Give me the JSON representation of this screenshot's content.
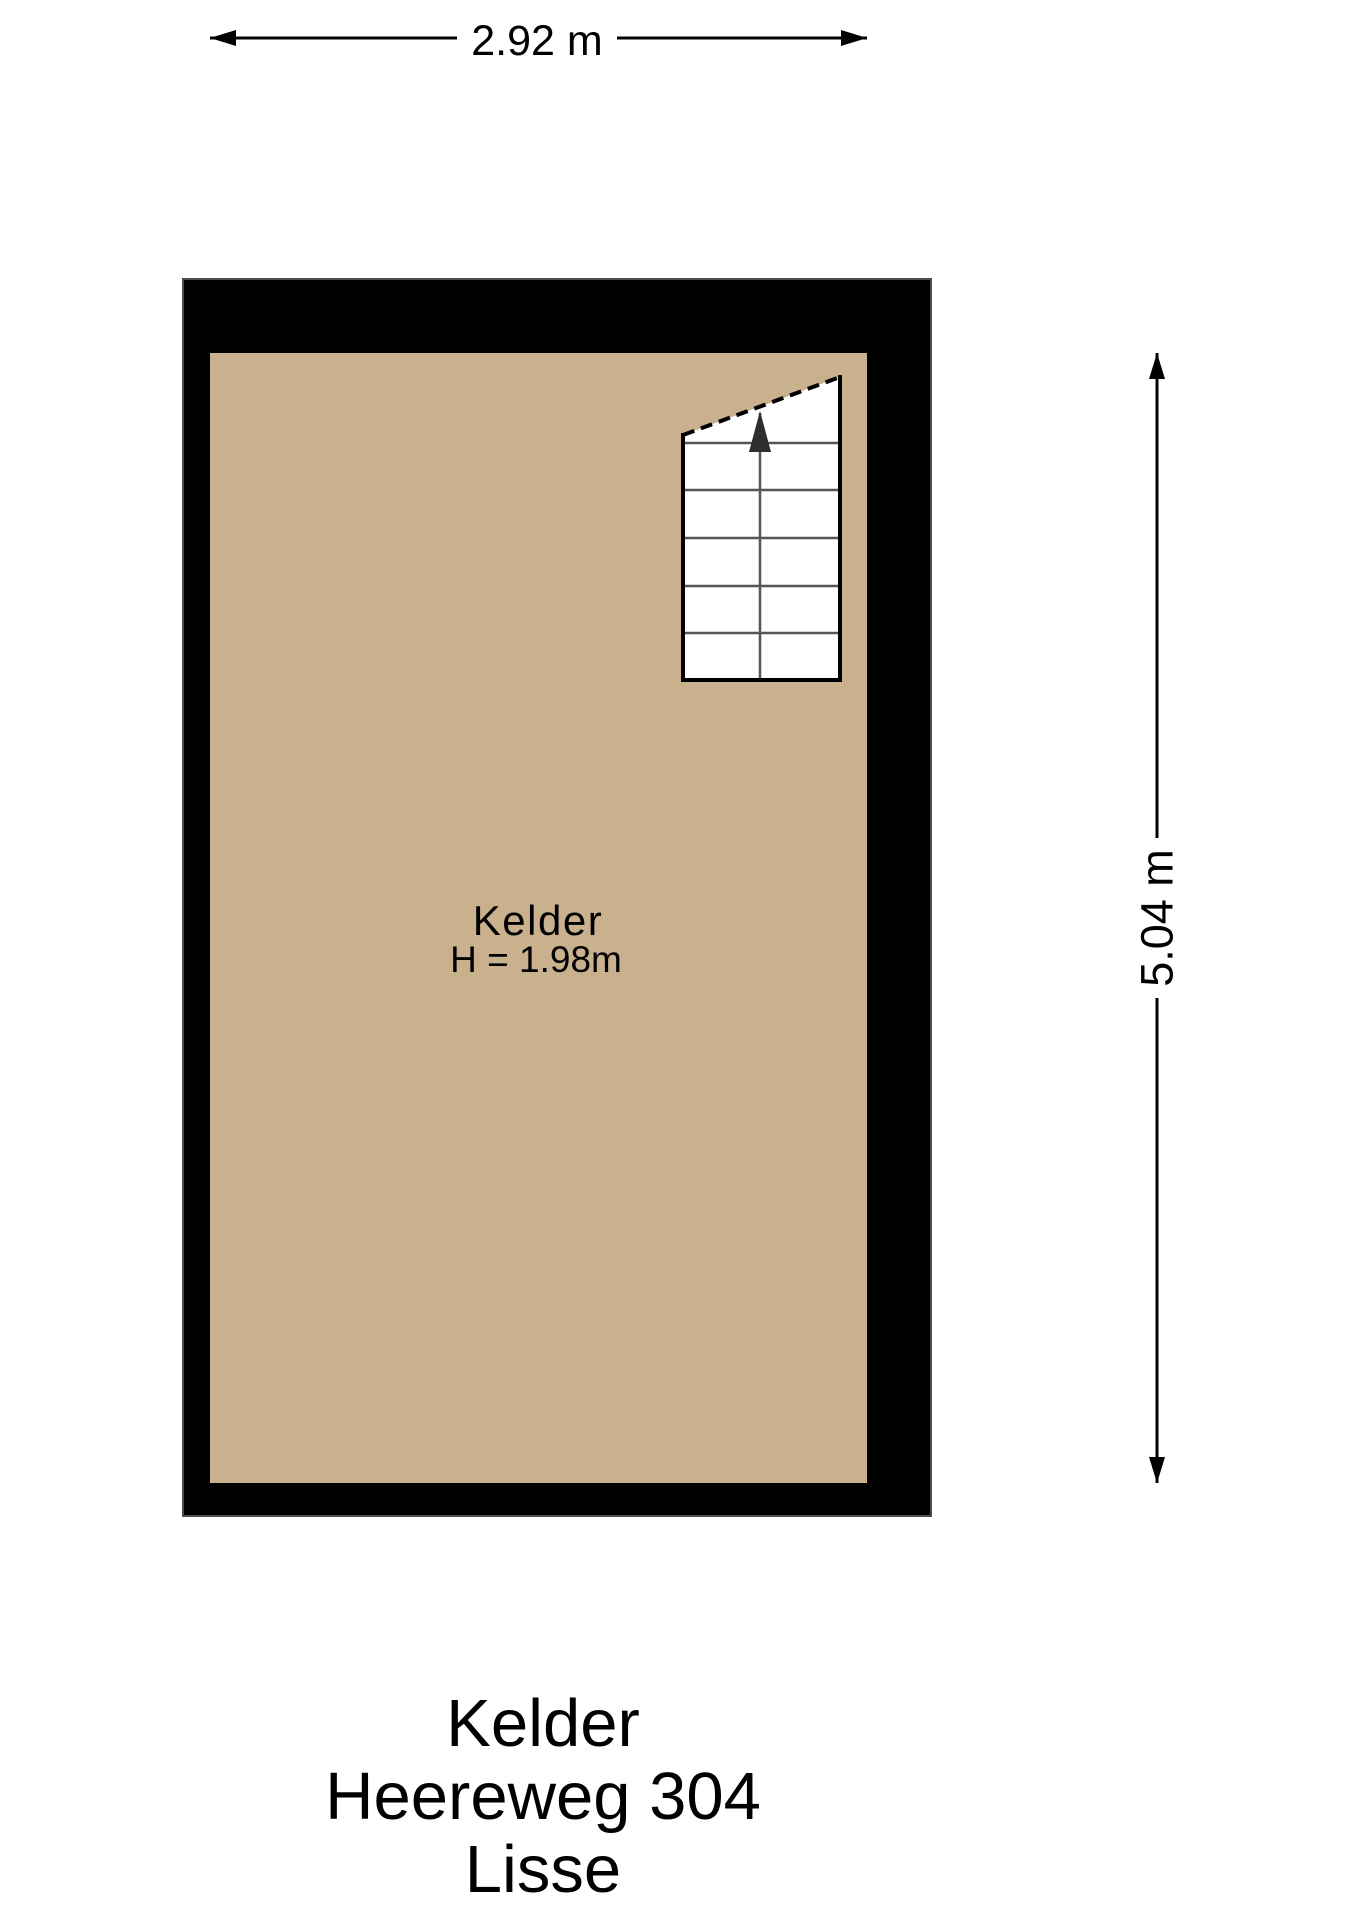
{
  "colors": {
    "background": "#FFFFFF",
    "wall": "#000000",
    "wall_edge": "#4d4d4d",
    "floor": "#C9B18E",
    "stair_line": "#555555",
    "stair_arrow": "#2e2e2e",
    "line": "#000000",
    "text": "#000000"
  },
  "dimensions": {
    "width_label": "2.92 m",
    "height_label": "5.04 m"
  },
  "room": {
    "name": "Kelder",
    "ceiling_height": "H = 1.98m"
  },
  "footer": {
    "room": "Kelder",
    "address": "Heereweg 304",
    "city": "Lisse"
  }
}
